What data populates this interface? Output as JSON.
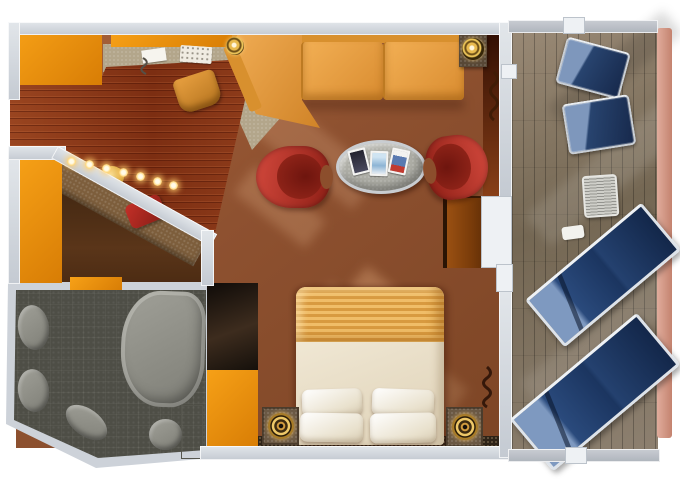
{
  "scene": {
    "label": "Cruise ship suite floor plan with private balcony, top-down view",
    "rooms": {
      "entry_hall": {
        "floor": "hardwood"
      },
      "living_room": {
        "floor": "carpet",
        "furniture": [
          "sectional-sofa",
          "corner-sofa-seat",
          "sofa-side-table",
          "sofa-table-lamp",
          "coffee-table",
          "magazines",
          "red-armchair-left",
          "red-armchair-right",
          "desk",
          "desk-chair",
          "telephone",
          "notepad",
          "desk-lamp"
        ]
      },
      "vanity_nook": {
        "furniture": [
          "lighted-counter",
          "vanity-lights",
          "gold-sink-bowl",
          "red-stool"
        ]
      },
      "bathroom": {
        "floor": "dark-tile",
        "fixtures": [
          "sink",
          "sink",
          "bathtub",
          "bidet",
          "toilet",
          "towel-ladder"
        ]
      },
      "bedroom": {
        "furniture": [
          "double-bed",
          "striped-blanket",
          "pillows",
          "nightstand-left",
          "nightstand-right",
          "spiral-lamp-left",
          "spiral-lamp-right",
          "plant",
          "dresser",
          "dark-closet"
        ]
      },
      "balcony": {
        "floor": "wood-deck",
        "furniture": [
          "deck-chair",
          "deck-chair",
          "patio-table",
          "footrest",
          "sun-lounger",
          "sun-lounger"
        ]
      },
      "closets": [
        "wardrobe-top-left",
        "wardrobe-left",
        "wardrobe-lower"
      ]
    },
    "counts": {
      "red_armchairs": 2,
      "balcony_deck_chairs": 2,
      "sun_loungers": 2,
      "bed_pillows": 4,
      "vanity_lights": 7,
      "magazines": 3,
      "bathroom_sinks": 2
    },
    "colors": {
      "wall_gray": "#ccd2da",
      "wardrobe_orange": "#e68a0d",
      "carpet_rust": "#96542e",
      "hardwood_red": "#8a3a1c",
      "carpet_beige": "#b3a68b",
      "sofa_tan": "#e8a444",
      "armchair_red": "#c03428",
      "bathroom_tile": "#4e4e46",
      "fixture_gray": "#93938b",
      "deck_taupe": "#84755f",
      "lounger_navy": "#1c3866",
      "lounger_light_blue": "#7e97bc",
      "railing_salmon": "#d49482",
      "bed_cream": "#f1e9d6",
      "blanket_stripe": "#e7b058",
      "lamp_gold": "#d9a83c"
    }
  }
}
